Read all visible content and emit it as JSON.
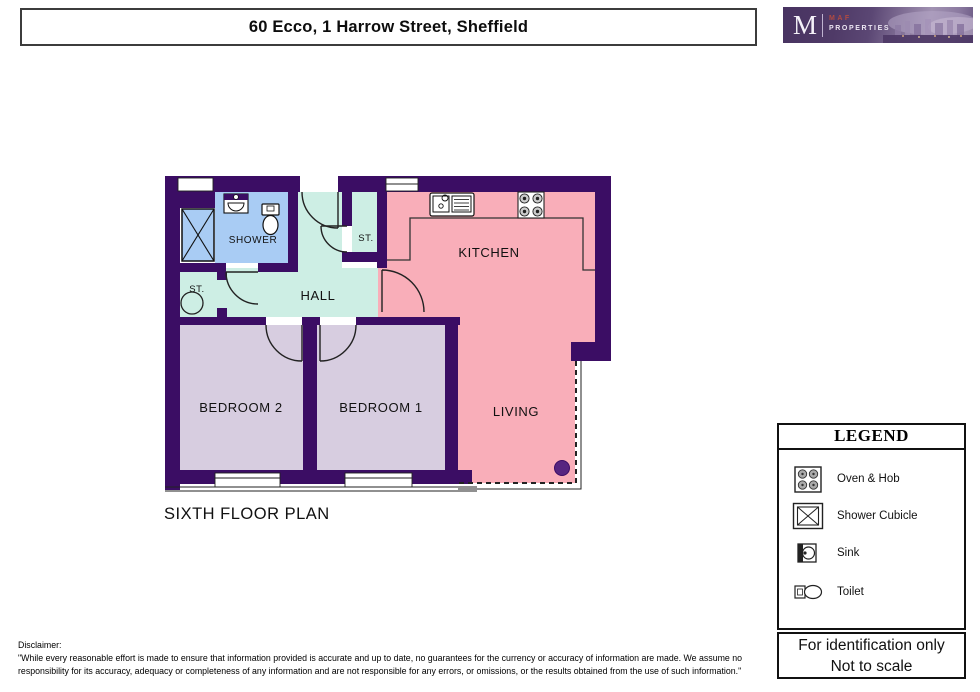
{
  "header": {
    "title": "60 Ecco, 1 Harrow Street, Sheffield"
  },
  "logo": {
    "initial": "M",
    "brand_top": "MAF",
    "brand_bottom": "PROPERTIES"
  },
  "plan": {
    "caption": "SIXTH FLOOR PLAN",
    "rooms": {
      "shower": "SHOWER",
      "storage_top": "ST.",
      "storage_left": "ST.",
      "hall": "HALL",
      "kitchen": "KITCHEN",
      "living": "LIVING",
      "bedroom1": "BEDROOM 1",
      "bedroom2": "BEDROOM 2"
    },
    "colors": {
      "wall": "#3b0d64",
      "shower_room": "#a9ccf4",
      "hall": "#cdeee4",
      "kitchen_living": "#f9aeb9",
      "bedroom": "#d7cde0",
      "column_dot": "#562580",
      "logo_purple": "#4f3a67",
      "logo_brand_red": "#b04a42"
    }
  },
  "legend": {
    "title": "LEGEND",
    "items": [
      {
        "icon": "oven-hob-icon",
        "label": "Oven & Hob"
      },
      {
        "icon": "shower-cubicle-icon",
        "label": "Shower Cubicle"
      },
      {
        "icon": "sink-icon",
        "label": "Sink"
      },
      {
        "icon": "toilet-icon",
        "label": "Toilet"
      }
    ],
    "note_line1": "For identification only",
    "note_line2": "Not to scale"
  },
  "footer": {
    "disclaimer_label": "Disclaimer:",
    "disclaimer_text": "\"While every reasonable effort is made to ensure that information provided is accurate and up to date, no guarantees for the currency or accuracy of information are made. We assume no responsibility for its accuracy, adequacy or completeness of any information and are not responsible for any errors, or omissions, or the results obtained from the use of such information.\""
  }
}
